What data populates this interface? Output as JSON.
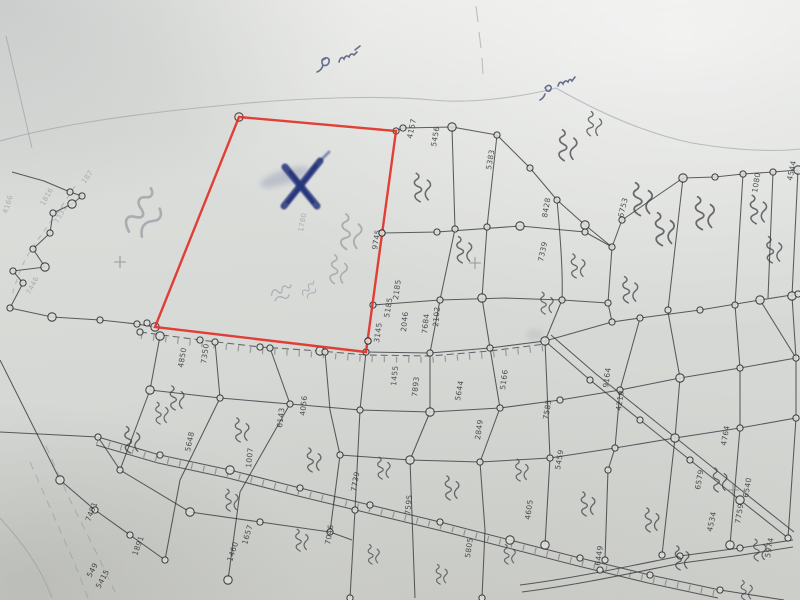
{
  "document": {
    "kind": "photograph of a hand-drawn cadastral village survey map (field measurement sketch)",
    "script_style": "Telugu-style handwritten parcel annotations, mostly illegible",
    "highlight_meaning": "one large empty parcel outlined in red and marked with a blue ink X"
  },
  "annotations": [
    {
      "id": "handwriting-top-center",
      "text": "illegible handwritten scrawl (blue pencil)",
      "x": 330,
      "y": 62
    },
    {
      "id": "handwriting-top-right",
      "text": "illegible handwritten scrawl (blue pencil)",
      "x": 557,
      "y": 85
    },
    {
      "id": "parcel-side-note",
      "text": "illegible vertical pencil note along red boundary",
      "x": 348,
      "y": 250
    },
    {
      "id": "left-margin-note",
      "text": "illegible pencil scrawl",
      "x": 140,
      "y": 215
    },
    {
      "id": "x-mark",
      "text": "blue ink X marking the highlighted parcel",
      "x": 301,
      "y": 183
    }
  ],
  "map": {
    "colors": {
      "paper": "#d8dad7",
      "ink": "#35353a",
      "pencil": "#9298a0",
      "red_outline": "#e23128",
      "blue_ink": "#27367c",
      "handwriting": "#4d5880"
    },
    "red_parcel": {
      "points": [
        [
          239,
          117
        ],
        [
          396,
          131
        ],
        [
          366,
          352
        ],
        [
          155,
          327
        ]
      ],
      "stones_on_boundary": [
        [
          382,
          233
        ],
        [
          368,
          341
        ]
      ]
    },
    "x_mark": {
      "cx": 301,
      "cy": 183
    },
    "crosses": [
      [
        120,
        262
      ],
      [
        475,
        263
      ],
      [
        733,
        490
      ]
    ],
    "nodes": [
      [
        239,
        117
      ],
      [
        396,
        131
      ],
      [
        382,
        233
      ],
      [
        368,
        341
      ],
      [
        155,
        327
      ],
      [
        147,
        323
      ],
      [
        70,
        192
      ],
      [
        82,
        196
      ],
      [
        72,
        204
      ],
      [
        53,
        213
      ],
      [
        50,
        233
      ],
      [
        33,
        249
      ],
      [
        45,
        267
      ],
      [
        13,
        271
      ],
      [
        23,
        283
      ],
      [
        10,
        308
      ],
      [
        52,
        317
      ],
      [
        100,
        320
      ],
      [
        137,
        324
      ],
      [
        403,
        128
      ],
      [
        452,
        127
      ],
      [
        497,
        135
      ],
      [
        530,
        168
      ],
      [
        557,
        200
      ],
      [
        585,
        225
      ],
      [
        612,
        247
      ],
      [
        437,
        232
      ],
      [
        455,
        229
      ],
      [
        520,
        226
      ],
      [
        585,
        232
      ],
      [
        440,
        300
      ],
      [
        487,
        227
      ],
      [
        482,
        298
      ],
      [
        562,
        300
      ],
      [
        608,
        303
      ],
      [
        373,
        305
      ],
      [
        683,
        178
      ],
      [
        715,
        177
      ],
      [
        743,
        174
      ],
      [
        773,
        172
      ],
      [
        798,
        170
      ],
      [
        622,
        220
      ],
      [
        668,
        310
      ],
      [
        735,
        305
      ],
      [
        792,
        296
      ],
      [
        140,
        332
      ],
      [
        200,
        340
      ],
      [
        260,
        347
      ],
      [
        320,
        351
      ],
      [
        366,
        352
      ],
      [
        430,
        353
      ],
      [
        490,
        348
      ],
      [
        545,
        341
      ],
      [
        612,
        322
      ],
      [
        640,
        318
      ],
      [
        700,
        310
      ],
      [
        760,
        300
      ],
      [
        798,
        294
      ],
      [
        98,
        437
      ],
      [
        160,
        455
      ],
      [
        230,
        470
      ],
      [
        300,
        488
      ],
      [
        370,
        505
      ],
      [
        440,
        522
      ],
      [
        510,
        540
      ],
      [
        580,
        558
      ],
      [
        650,
        575
      ],
      [
        720,
        590
      ],
      [
        150,
        390
      ],
      [
        220,
        398
      ],
      [
        290,
        404
      ],
      [
        360,
        410
      ],
      [
        430,
        412
      ],
      [
        500,
        408
      ],
      [
        560,
        400
      ],
      [
        620,
        390
      ],
      [
        680,
        378
      ],
      [
        740,
        368
      ],
      [
        796,
        358
      ],
      [
        340,
        455
      ],
      [
        410,
        460
      ],
      [
        480,
        462
      ],
      [
        550,
        458
      ],
      [
        615,
        448
      ],
      [
        675,
        438
      ],
      [
        740,
        428
      ],
      [
        796,
        418
      ],
      [
        120,
        470
      ],
      [
        190,
        512
      ],
      [
        260,
        522
      ],
      [
        330,
        532
      ],
      [
        165,
        560
      ],
      [
        228,
        580
      ],
      [
        355,
        510
      ],
      [
        350,
        598
      ],
      [
        482,
        598
      ],
      [
        545,
        545
      ],
      [
        608,
        470
      ],
      [
        605,
        560
      ],
      [
        662,
        555
      ],
      [
        730,
        545
      ],
      [
        590,
        380
      ],
      [
        640,
        420
      ],
      [
        690,
        460
      ],
      [
        740,
        500
      ],
      [
        788,
        538
      ],
      [
        95,
        510
      ],
      [
        130,
        535
      ],
      [
        60,
        480
      ],
      [
        600,
        570
      ],
      [
        680,
        556
      ],
      [
        740,
        548
      ],
      [
        160,
        336
      ],
      [
        215,
        342
      ],
      [
        270,
        348
      ],
      [
        325,
        352
      ]
    ],
    "survey_numbers": [
      [
        "4157",
        412,
        139,
        -78
      ],
      [
        "5456",
        436,
        147,
        -80
      ],
      [
        "5383",
        491,
        170,
        -80
      ],
      [
        "8428",
        547,
        218,
        -80
      ],
      [
        "6753",
        623,
        218,
        -76
      ],
      [
        "4544",
        792,
        181,
        -78
      ],
      [
        "1080",
        757,
        193,
        -80
      ],
      [
        "7339",
        543,
        262,
        -78
      ],
      [
        "9745",
        377,
        250,
        -80
      ],
      [
        "2185",
        398,
        300,
        -82
      ],
      [
        "5185",
        389,
        318,
        -80
      ],
      [
        "3145",
        379,
        343,
        -82
      ],
      [
        "2046",
        406,
        332,
        -84
      ],
      [
        "7684",
        427,
        334,
        -84
      ],
      [
        "2102",
        438,
        327,
        -85
      ],
      [
        "1455",
        396,
        386,
        -84
      ],
      [
        "7893",
        417,
        397,
        -84
      ],
      [
        "5644",
        460,
        401,
        -80
      ],
      [
        "5166",
        505,
        390,
        -82
      ],
      [
        "9164",
        608,
        388,
        -82
      ],
      [
        "4219",
        621,
        411,
        -82
      ],
      [
        "4764",
        726,
        446,
        -80
      ],
      [
        "6579",
        700,
        490,
        -80
      ],
      [
        "6540",
        748,
        498,
        -80
      ],
      [
        "4534",
        712,
        532,
        -78
      ],
      [
        "7595",
        410,
        515,
        -84
      ],
      [
        "7739",
        356,
        492,
        -80
      ],
      [
        "5805",
        470,
        558,
        -82
      ],
      [
        "4605",
        530,
        520,
        -82
      ],
      [
        "6449",
        600,
        566,
        -82
      ],
      [
        "7759",
        740,
        524,
        -80
      ],
      [
        "5974",
        770,
        558,
        -80
      ],
      [
        "4850",
        183,
        368,
        -80
      ],
      [
        "7350",
        206,
        364,
        -82
      ],
      [
        "5648",
        190,
        452,
        -78
      ],
      [
        "6143",
        282,
        428,
        -83
      ],
      [
        "1007",
        251,
        468,
        -84
      ],
      [
        "4056",
        305,
        416,
        -84
      ],
      [
        "7585",
        548,
        420,
        -80
      ],
      [
        "5459",
        560,
        470,
        -80
      ],
      [
        "2849",
        480,
        440,
        -82
      ],
      [
        "7046",
        330,
        545,
        -80
      ],
      [
        "1657",
        247,
        545,
        -74
      ],
      [
        "1460",
        232,
        562,
        -72
      ],
      [
        "1891",
        137,
        556,
        -70
      ],
      [
        "7481",
        90,
        522,
        -68
      ],
      [
        "5415",
        100,
        589,
        -62
      ],
      [
        "549",
        91,
        578,
        -62
      ],
      [
        "1816",
        44,
        206,
        -60,
        1
      ],
      [
        "7331",
        58,
        224,
        -62,
        1
      ],
      [
        "187",
        85,
        184,
        -55,
        1
      ],
      [
        "4166",
        7,
        214,
        -72,
        1
      ],
      [
        "7446",
        30,
        295,
        -62,
        1
      ],
      [
        "1780",
        303,
        232,
        -80,
        1
      ]
    ],
    "script_marks": [
      [
        140,
        215,
        -50,
        2.2,
        1
      ],
      [
        348,
        235,
        -78,
        1.6,
        1
      ],
      [
        336,
        272,
        -76,
        1.3,
        1
      ],
      [
        280,
        292,
        -15,
        1.0,
        1
      ],
      [
        308,
        290,
        -40,
        0.8,
        1
      ],
      [
        565,
        148,
        -80,
        1.4
      ],
      [
        592,
        126,
        -75,
        1.1
      ],
      [
        420,
        190,
        -85,
        1.3
      ],
      [
        462,
        252,
        -85,
        1.2
      ],
      [
        545,
        305,
        -85,
        1.0
      ],
      [
        576,
        268,
        -85,
        1.1
      ],
      [
        640,
        202,
        -85,
        1.5
      ],
      [
        662,
        232,
        -85,
        1.5
      ],
      [
        702,
        216,
        -85,
        1.5
      ],
      [
        756,
        212,
        -85,
        1.3
      ],
      [
        772,
        252,
        -85,
        1.2
      ],
      [
        628,
        292,
        -85,
        1.2
      ],
      [
        175,
        400,
        -85,
        1.1
      ],
      [
        240,
        432,
        -85,
        1.1
      ],
      [
        312,
        462,
        -85,
        1.1
      ],
      [
        382,
        470,
        -85,
        1.0
      ],
      [
        450,
        490,
        -85,
        1.1
      ],
      [
        520,
        472,
        -85,
        1.0
      ],
      [
        586,
        506,
        -85,
        1.1
      ],
      [
        650,
        522,
        -85,
        1.1
      ],
      [
        718,
        482,
        -85,
        1.1
      ],
      [
        758,
        552,
        -85,
        1.0
      ],
      [
        230,
        502,
        -85,
        1.0
      ],
      [
        300,
        542,
        -85,
        1.0
      ],
      [
        372,
        556,
        -85,
        0.9
      ],
      [
        440,
        576,
        -85,
        0.9
      ],
      [
        508,
        556,
        -85,
        0.9
      ],
      [
        130,
        442,
        -85,
        1.2
      ],
      [
        160,
        415,
        -85,
        1.0
      ],
      [
        680,
        560,
        -85,
        1.1
      ],
      [
        745,
        592,
        -85,
        0.9
      ]
    ]
  }
}
